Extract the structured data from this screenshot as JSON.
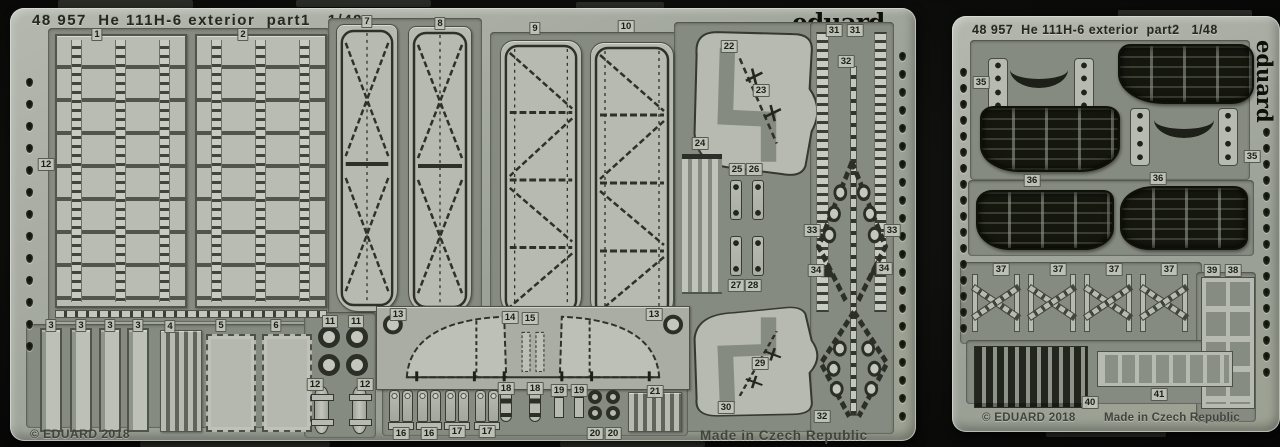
{
  "photo": {
    "background_color": "#0b0b0a",
    "sheet_color": "#a8aca2",
    "part_color": "#b6bab1",
    "web_color": "#868b81",
    "etch_line_color": "#2e312a",
    "grille_color": "#15170f"
  },
  "left_sheet": {
    "header": "48 957  He 111H-6 exterior  part1   1/48",
    "logo": "eduard",
    "copyright": "© EDUARD 2018",
    "made_in": "Made in Czech Republic",
    "part_labels": [
      {
        "t": "1",
        "x": 87,
        "y": 20
      },
      {
        "t": "2",
        "x": 233,
        "y": 20
      },
      {
        "t": "7",
        "x": 357,
        "y": 7
      },
      {
        "t": "8",
        "x": 430,
        "y": 9
      },
      {
        "t": "9",
        "x": 525,
        "y": 14
      },
      {
        "t": "10",
        "x": 616,
        "y": 12
      },
      {
        "t": "22",
        "x": 719,
        "y": 32
      },
      {
        "t": "23",
        "x": 751,
        "y": 76
      },
      {
        "t": "31",
        "x": 824,
        "y": 16
      },
      {
        "t": "31",
        "x": 845,
        "y": 16
      },
      {
        "t": "32",
        "x": 836,
        "y": 47
      },
      {
        "t": "24",
        "x": 690,
        "y": 129
      },
      {
        "t": "25",
        "x": 727,
        "y": 155
      },
      {
        "t": "26",
        "x": 744,
        "y": 155
      },
      {
        "t": "12",
        "x": 36,
        "y": 150
      },
      {
        "t": "33",
        "x": 802,
        "y": 216
      },
      {
        "t": "33",
        "x": 882,
        "y": 216
      },
      {
        "t": "34",
        "x": 806,
        "y": 256
      },
      {
        "t": "34",
        "x": 874,
        "y": 254
      },
      {
        "t": "27",
        "x": 726,
        "y": 271
      },
      {
        "t": "28",
        "x": 743,
        "y": 271
      },
      {
        "t": "29",
        "x": 750,
        "y": 349
      },
      {
        "t": "30",
        "x": 716,
        "y": 393
      },
      {
        "t": "32",
        "x": 812,
        "y": 402
      },
      {
        "t": "3",
        "x": 41,
        "y": 311
      },
      {
        "t": "3",
        "x": 71,
        "y": 311
      },
      {
        "t": "3",
        "x": 100,
        "y": 311
      },
      {
        "t": "3",
        "x": 128,
        "y": 311
      },
      {
        "t": "4",
        "x": 160,
        "y": 312
      },
      {
        "t": "5",
        "x": 211,
        "y": 311
      },
      {
        "t": "6",
        "x": 266,
        "y": 311
      },
      {
        "t": "11",
        "x": 320,
        "y": 307
      },
      {
        "t": "11",
        "x": 346,
        "y": 307
      },
      {
        "t": "13",
        "x": 388,
        "y": 300
      },
      {
        "t": "14",
        "x": 500,
        "y": 303
      },
      {
        "t": "15",
        "x": 520,
        "y": 304
      },
      {
        "t": "13",
        "x": 644,
        "y": 300
      },
      {
        "t": "12",
        "x": 305,
        "y": 370
      },
      {
        "t": "12",
        "x": 355,
        "y": 370
      },
      {
        "t": "16",
        "x": 391,
        "y": 419
      },
      {
        "t": "16",
        "x": 419,
        "y": 419
      },
      {
        "t": "17",
        "x": 447,
        "y": 417
      },
      {
        "t": "17",
        "x": 477,
        "y": 417
      },
      {
        "t": "18",
        "x": 496,
        "y": 374
      },
      {
        "t": "18",
        "x": 525,
        "y": 374
      },
      {
        "t": "19",
        "x": 549,
        "y": 376
      },
      {
        "t": "19",
        "x": 569,
        "y": 376
      },
      {
        "t": "20",
        "x": 585,
        "y": 419
      },
      {
        "t": "20",
        "x": 603,
        "y": 419
      },
      {
        "t": "21",
        "x": 645,
        "y": 377
      }
    ]
  },
  "right_sheet": {
    "header": "48 957  He 111H-6 exterior  part2   1/48",
    "logo": "eduard",
    "copyright": "© EDUARD 2018",
    "made_in": "Made in Czech Republic",
    "part_labels": [
      {
        "t": "35",
        "x": 29,
        "y": 60
      },
      {
        "t": "35",
        "x": 300,
        "y": 134
      },
      {
        "t": "36",
        "x": 80,
        "y": 158
      },
      {
        "t": "36",
        "x": 206,
        "y": 156
      },
      {
        "t": "37",
        "x": 49,
        "y": 247
      },
      {
        "t": "37",
        "x": 106,
        "y": 247
      },
      {
        "t": "37",
        "x": 162,
        "y": 247
      },
      {
        "t": "37",
        "x": 217,
        "y": 247
      },
      {
        "t": "39",
        "x": 260,
        "y": 248
      },
      {
        "t": "38",
        "x": 281,
        "y": 248
      },
      {
        "t": "40",
        "x": 138,
        "y": 380
      },
      {
        "t": "41",
        "x": 207,
        "y": 372
      }
    ]
  }
}
